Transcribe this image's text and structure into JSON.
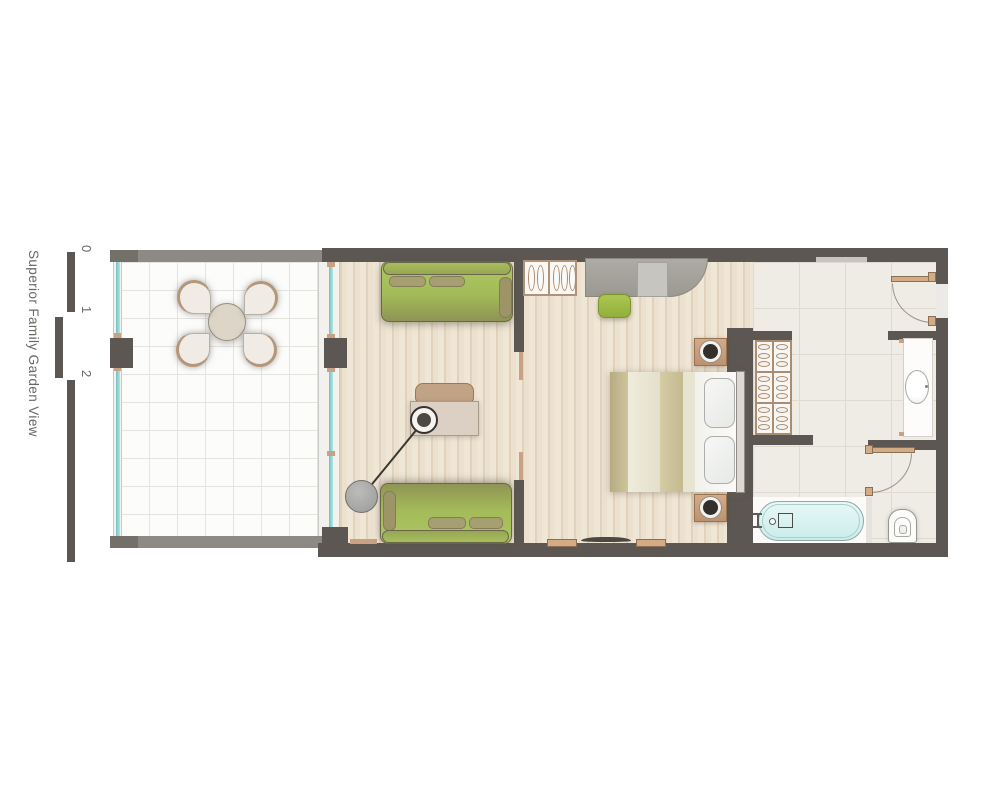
{
  "title": "Superior Family Garden View",
  "scale_bar": {
    "labels": [
      "0",
      "1",
      "2",
      "5"
    ]
  },
  "colors": {
    "wall_dark": "#5c5752",
    "terrace_parapet": "#8d8a86",
    "glass_teal": "#7fcfcf",
    "sofa_green": "#a9c35c",
    "stool_green": "#a4c04b",
    "accent_tan": "#c9a183",
    "wood_floor": "#ece1cf",
    "bath_tile": "#efebe5",
    "tub_blue": "#d6f1ef",
    "label_gray": "#6b6763"
  },
  "rooms": {
    "terrace": {
      "furniture": [
        "round-dining-table",
        "fan-chair-nw",
        "fan-chair-ne",
        "fan-chair-sw",
        "fan-chair-se"
      ]
    },
    "living": {
      "furniture": [
        "sofa-top",
        "sofa-bottom",
        "coffee-table",
        "armchair",
        "floor-lamp"
      ]
    },
    "bedroom": {
      "furniture": [
        "double-bed",
        "pillows",
        "nightstand-top",
        "nightstand-bottom",
        "hanger-closet",
        "gray-desk",
        "desk-chair",
        "green-stool",
        "wall-tv",
        "shelf-left",
        "shelf-right"
      ]
    },
    "bathroom": {
      "furniture": [
        "towel-wardrobe",
        "washbasin-counter",
        "bathtub",
        "toilet",
        "entry-door",
        "wc-door"
      ]
    }
  }
}
